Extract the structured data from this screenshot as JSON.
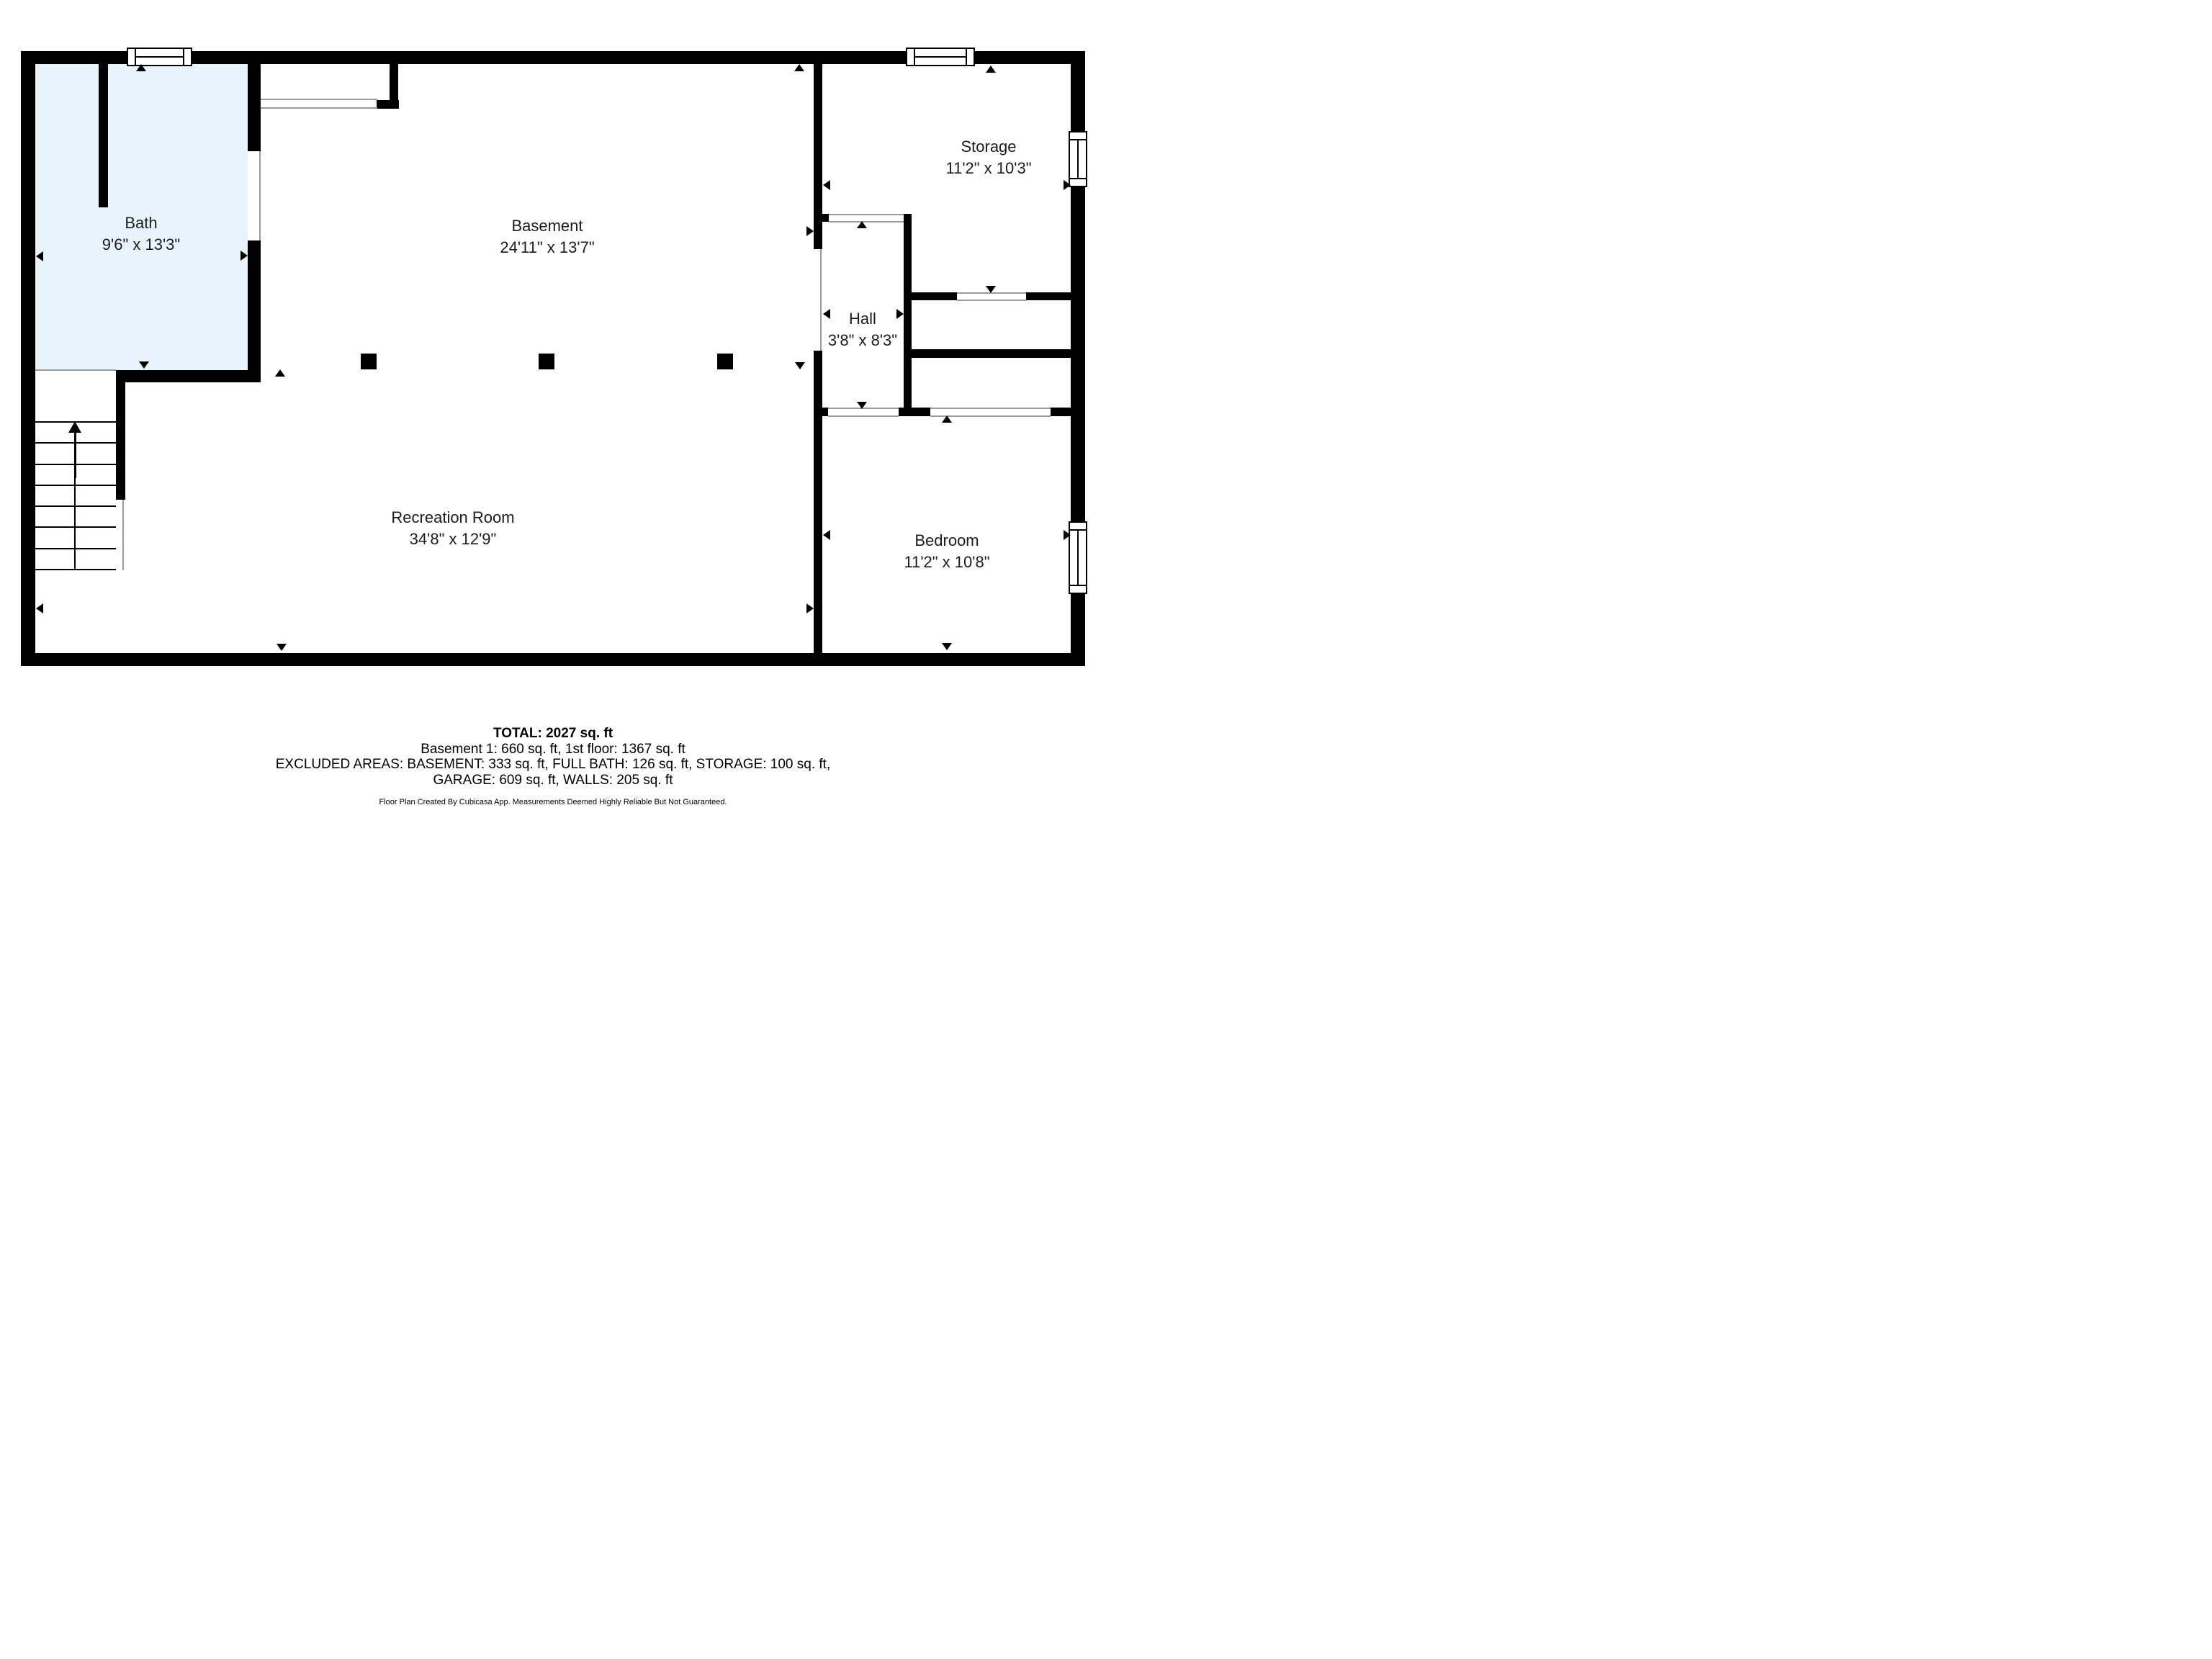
{
  "app": "Cubicasa floor plan",
  "colors": {
    "wall": "#000000",
    "bath_fill": "#E8F4FC",
    "opening_line": "#9B9B9B",
    "label_text": "#1C1C1C",
    "background": "#FFFFFF"
  },
  "icons": {
    "measure_arrow_up": "▲",
    "measure_arrow_down": "▼",
    "measure_arrow_left": "◀",
    "measure_arrow_right": "▶",
    "stairs_direction_arrow": "↑ (up arrow along staircase)"
  },
  "rooms": [
    {
      "name": "Bath",
      "dims": "9'6\" x 13'3\""
    },
    {
      "name": "Basement",
      "dims": "24'11\" x 13'7\""
    },
    {
      "name": "Storage",
      "dims": "11'2\" x 10'3\""
    },
    {
      "name": "Hall",
      "dims": "3'8\" x 8'3\""
    },
    {
      "name": "Bedroom",
      "dims": "11'2\" x 10'8\""
    },
    {
      "name": "Recreation Room",
      "dims": "34'8\" x 12'9\""
    }
  ],
  "footer": {
    "total": "TOTAL: 2027 sq. ft",
    "line2": "Basement 1: 660 sq. ft, 1st floor: 1367 sq. ft",
    "line3": "EXCLUDED AREAS: BASEMENT: 333 sq. ft, FULL BATH: 126 sq. ft, STORAGE: 100 sq. ft,",
    "line4": "GARAGE: 609 sq. ft, WALLS: 205 sq. ft",
    "disclaimer": "Floor Plan Created By Cubicasa App. Measurements Deemed Highly Reliable But Not Guaranteed."
  }
}
